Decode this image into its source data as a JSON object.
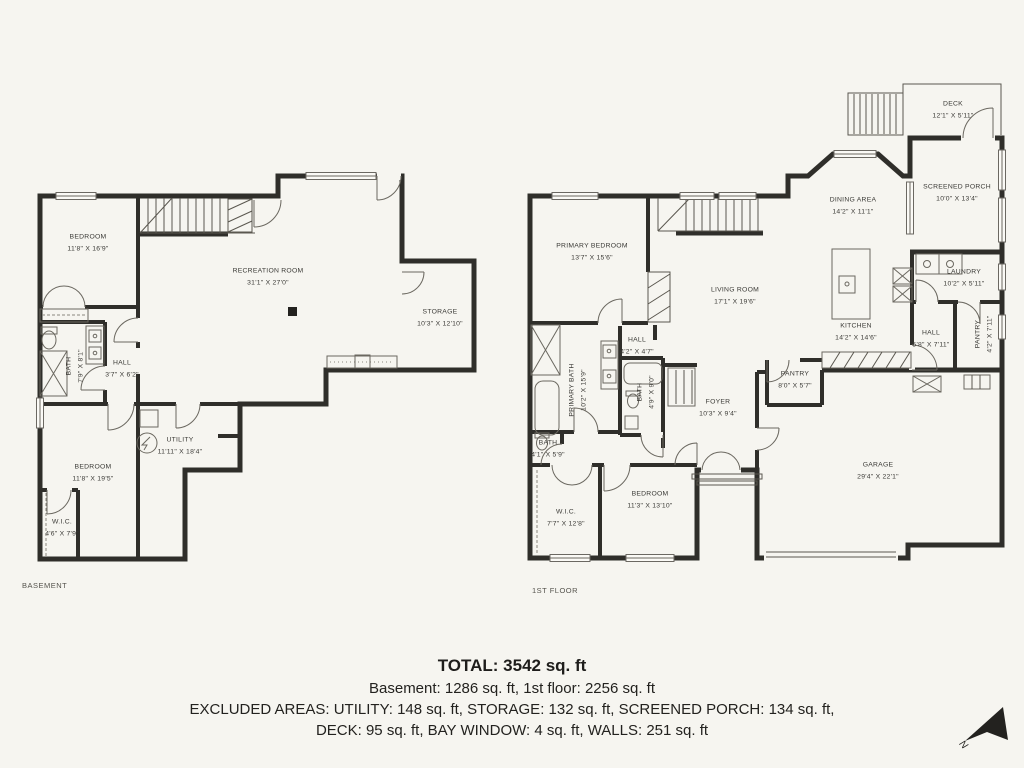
{
  "basement": {
    "floor_label": "BASEMENT",
    "rooms": [
      {
        "name": "BEDROOM",
        "dims": "11'8\" X 16'9\""
      },
      {
        "name": "RECREATION ROOM",
        "dims": "31'1\" X 27'0\""
      },
      {
        "name": "STORAGE",
        "dims": "10'3\" X 12'10\""
      },
      {
        "name": "BATH",
        "dims": "7'9\" X 8'1\""
      },
      {
        "name": "HALL",
        "dims": "3'7\" X 6'2\""
      },
      {
        "name": "UTILITY",
        "dims": "11'11\" X 18'4\""
      },
      {
        "name": "BEDROOM",
        "dims": "11'8\" X 19'5\""
      },
      {
        "name": "W.I.C.",
        "dims": "4'6\" X 7'9\""
      }
    ]
  },
  "first_floor": {
    "floor_label": "1ST FLOOR",
    "rooms": [
      {
        "name": "PRIMARY BEDROOM",
        "dims": "13'7\" X 15'6\""
      },
      {
        "name": "LIVING ROOM",
        "dims": "17'1\" X 19'6\""
      },
      {
        "name": "DINING AREA",
        "dims": "14'2\" X 11'1\""
      },
      {
        "name": "KITCHEN",
        "dims": "14'2\" X 14'6\""
      },
      {
        "name": "DECK",
        "dims": "12'1\" X 5'11\""
      },
      {
        "name": "SCREENED PORCH",
        "dims": "10'0\" X 13'4\""
      },
      {
        "name": "LAUNDRY",
        "dims": "10'2\" X 5'11\""
      },
      {
        "name": "HALL",
        "dims": "5'8\" X 7'11\""
      },
      {
        "name": "PANTRY",
        "dims": "4'2\" X 7'11\""
      },
      {
        "name": "HALL",
        "dims": "4'2\" X 4'7\""
      },
      {
        "name": "PRIMARY BATH",
        "dims": "10'2\" X 15'9\""
      },
      {
        "name": "BATH",
        "dims": "4'9\" X 9'0\""
      },
      {
        "name": "FOYER",
        "dims": "10'3\" X 9'4\""
      },
      {
        "name": "PANTRY",
        "dims": "8'0\" X 5'7\""
      },
      {
        "name": "BATH",
        "dims": "4'1\" X 5'9\""
      },
      {
        "name": "W.I.C.",
        "dims": "7'7\" X 12'8\""
      },
      {
        "name": "BEDROOM",
        "dims": "11'3\" X 13'10\""
      },
      {
        "name": "GARAGE",
        "dims": "29'4\" X 22'1\""
      }
    ]
  },
  "summary": {
    "total": "TOTAL: 3542 sq. ft",
    "floors": "Basement: 1286 sq. ft, 1st floor: 2256 sq. ft",
    "excluded_line1": "EXCLUDED AREAS: UTILITY: 148 sq. ft, STORAGE: 132 sq. ft, SCREENED PORCH: 134 sq. ft,",
    "excluded_line2": "DECK: 95 sq. ft, BAY WINDOW: 4 sq. ft, WALLS: 251 sq. ft"
  },
  "compass": {
    "label": "N"
  },
  "colors": {
    "background": "#f6f5f0",
    "walls": "#2f2e2a",
    "thin_lines": "#5a574f",
    "text": "#3b3a36"
  }
}
